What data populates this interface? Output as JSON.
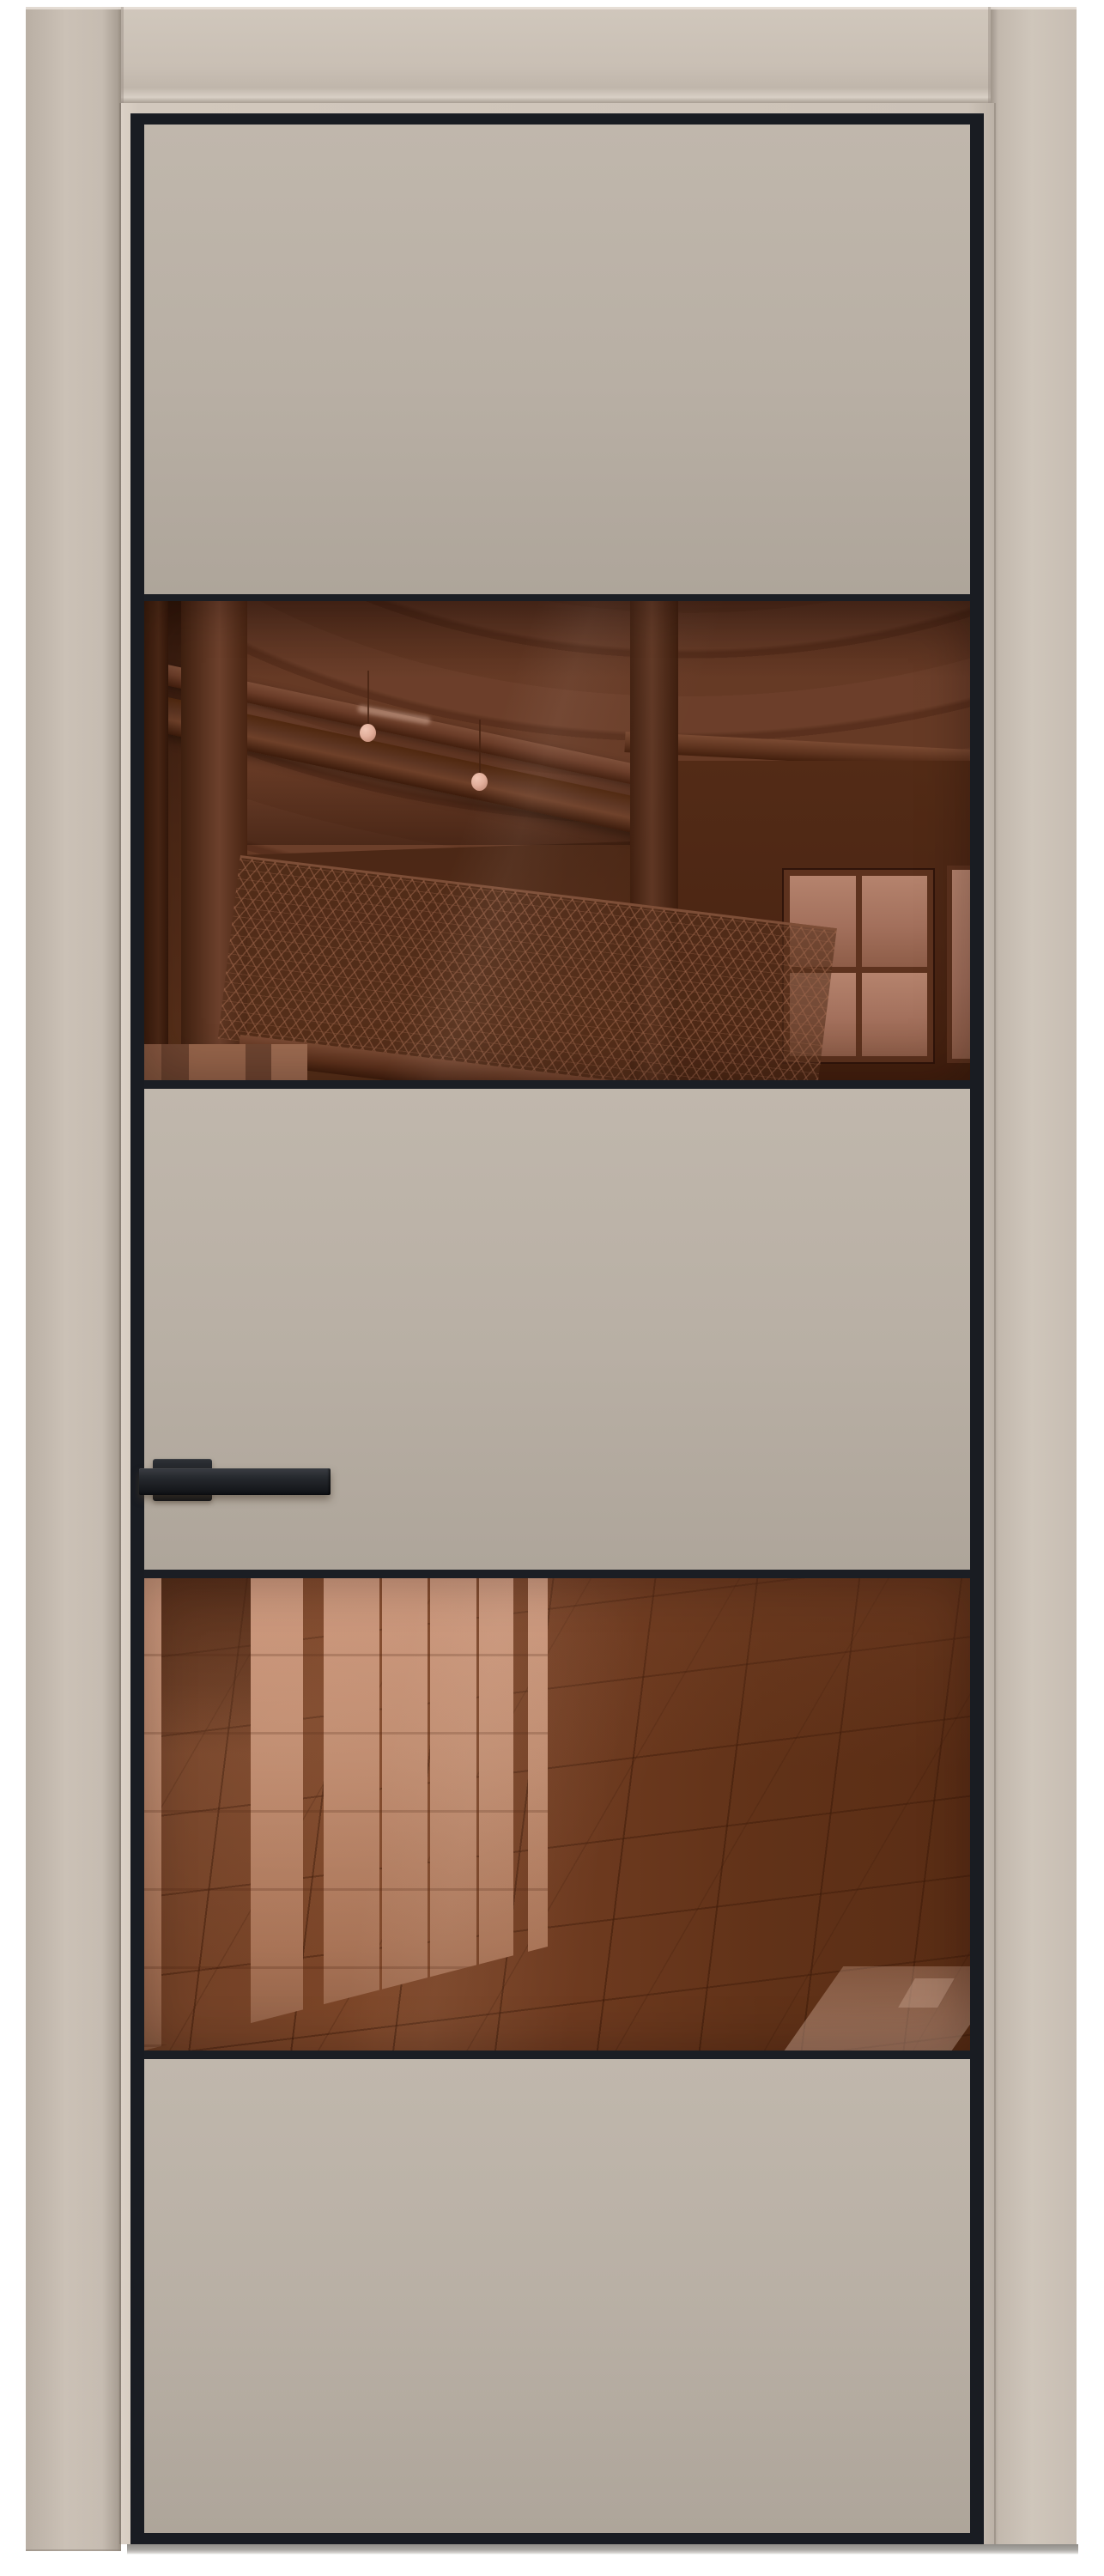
{
  "theme": {
    "bg": "#ffffff",
    "frame-mid": "#c7bdb2",
    "leaf-edge": "#d2c8bd",
    "panel-top": "#c0b7ac",
    "panel-bot": "#aea59a",
    "trim": "#191c22",
    "divider": "#1b1e24",
    "handle-dark": "#17191d",
    "handle-mid": "#26292e",
    "handle-hi": "#3a3d43",
    "g1-base": "#4b2715",
    "g1-duct": "#6e402b",
    "g1-wood": "#5d3522",
    "g1-wall": "#4c2614",
    "pane": "#a3705c",
    "bulb": "#e2af9b",
    "g2-light": "#bd8a6e",
    "g2-floor": "#6f3b20",
    "shadow": "#908d88"
  },
  "scene": {
    "kind": "interior-door-product-render",
    "door": {
      "leaf_color_name": "cashmere-beige",
      "trim_color_name": "black",
      "sections": [
        {
          "id": "top-panel",
          "kind": "solid-panel"
        },
        {
          "id": "upper-glass",
          "kind": "bronze-mirror-glass",
          "reflection": "industrial ceiling: round duct, beams, pendant bulbs, mezzanine mesh railing, window"
        },
        {
          "id": "middle-panel",
          "kind": "solid-panel",
          "hardware": "black lever handle on backplate, left side"
        },
        {
          "id": "lower-glass",
          "kind": "bronze-mirror-glass",
          "reflection": "glossy tiled floor with reflected light columns"
        },
        {
          "id": "bottom-panel",
          "kind": "solid-panel"
        }
      ],
      "glass_count": 2,
      "handle_side": "left"
    },
    "frame": {
      "style": "flat architrave, same beige finish",
      "visible_sides": [
        "left",
        "top",
        "right"
      ]
    },
    "background": "white with soft floor shadow under the door"
  }
}
